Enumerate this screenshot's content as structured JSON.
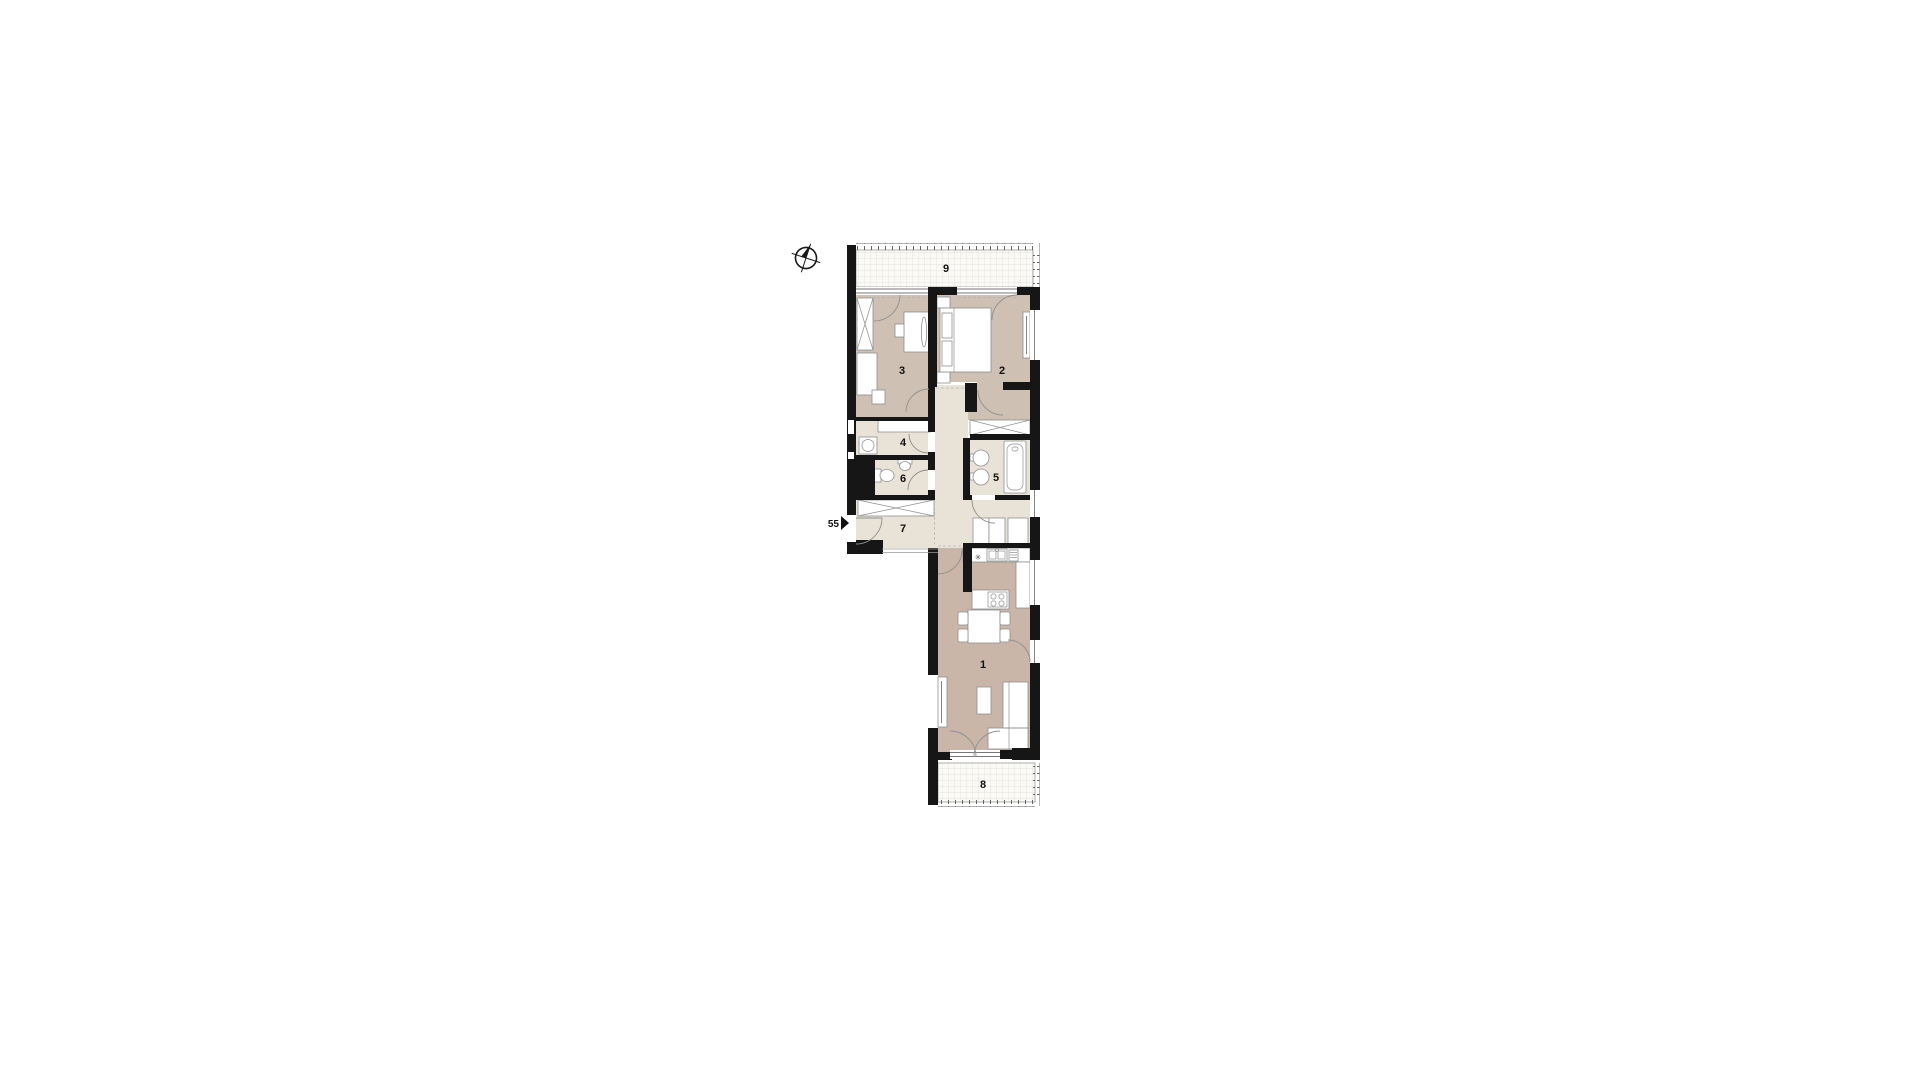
{
  "plan": {
    "unit_label": "55",
    "rooms": [
      {
        "number": "1"
      },
      {
        "number": "2"
      },
      {
        "number": "3"
      },
      {
        "number": "4"
      },
      {
        "number": "5"
      },
      {
        "number": "6"
      },
      {
        "number": "7"
      },
      {
        "number": "8"
      },
      {
        "number": "9"
      }
    ],
    "icons": {
      "north": "compass-icon",
      "entrance": "entrance-arrow-icon"
    },
    "colors": {
      "wall": "#161616",
      "room_main": "#cec0b2",
      "room_living": "#c9b6a8",
      "room_service": "#e8e3d6",
      "outdoor": "#fbfaf6",
      "grid_line": "#dddcd4",
      "furniture_outline": "#8f8f8f"
    }
  }
}
